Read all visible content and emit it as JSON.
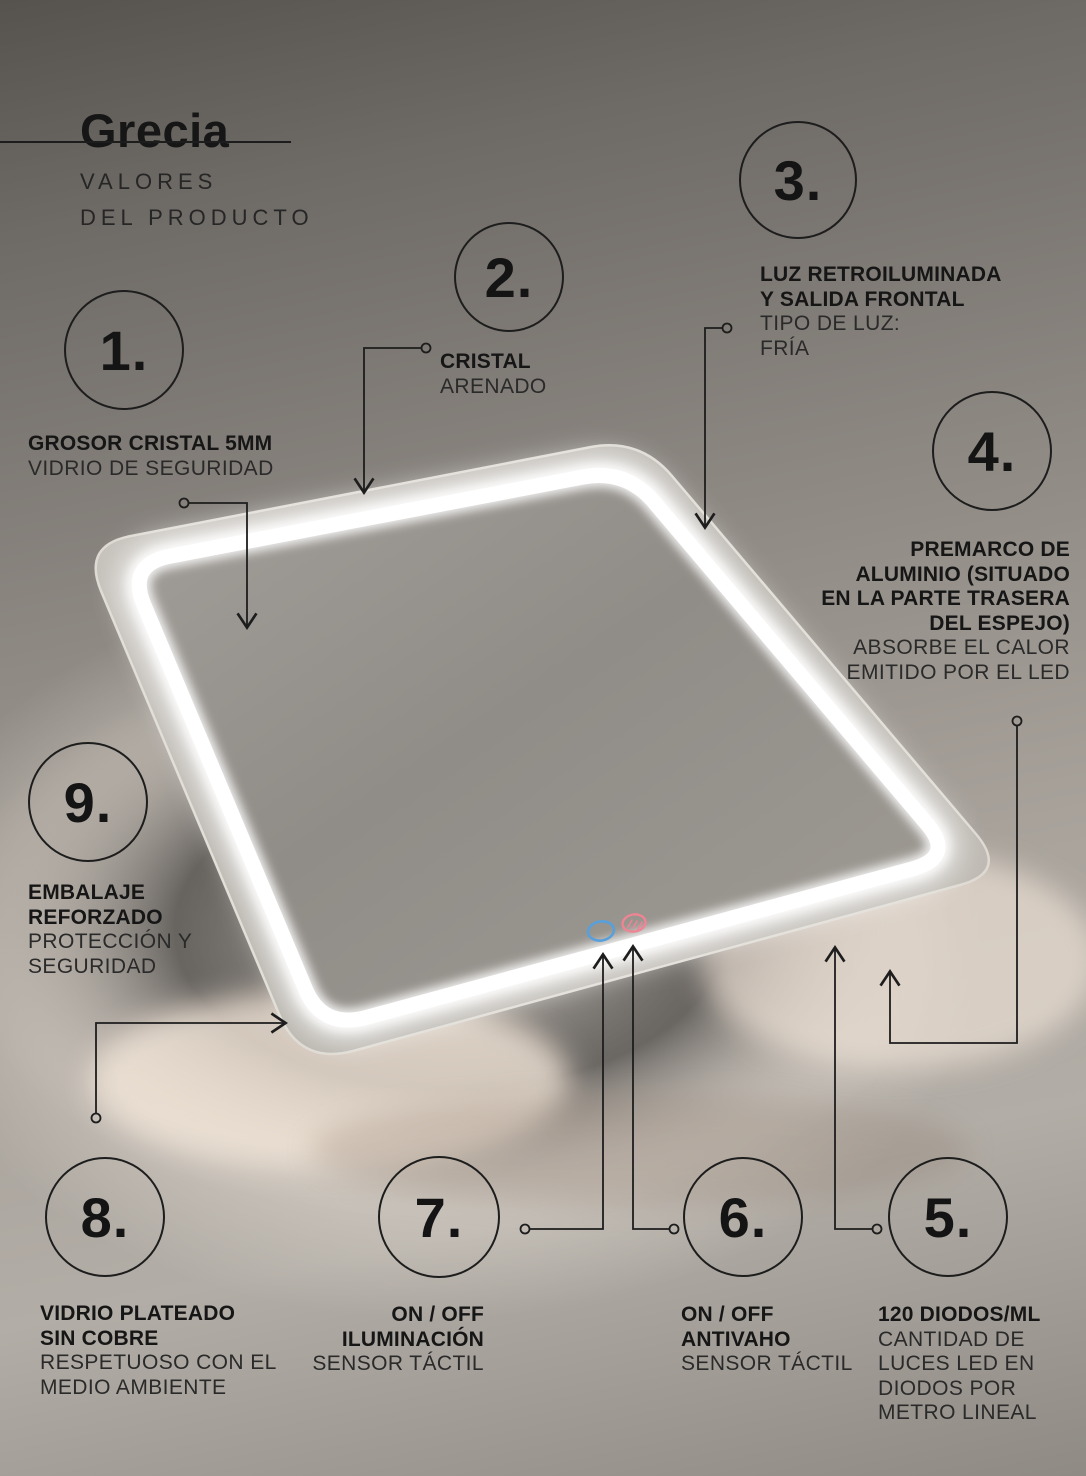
{
  "header": {
    "title": "Grecia",
    "subtitle": "VALORES\nDEL PRODUCTO"
  },
  "features": [
    {
      "number": "1.",
      "title": "GROSOR CRISTAL 5MM",
      "desc": "VIDRIO DE SEGURIDAD"
    },
    {
      "number": "2.",
      "title": "CRISTAL",
      "desc": "ARENADO"
    },
    {
      "number": "3.",
      "title": "LUZ RETROILUMINADA\nY SALIDA FRONTAL",
      "desc": "TIPO DE LUZ:\nFRÍA"
    },
    {
      "number": "4.",
      "title": "PREMARCO DE\nALUMINIO (SITUADO\nEN LA PARTE TRASERA\nDEL ESPEJO)",
      "desc": "ABSORBE EL CALOR\nEMITIDO POR EL LED"
    },
    {
      "number": "5.",
      "title": "120 DIODOS/ML",
      "desc": "CANTIDAD DE\nLUCES LED EN\nDIODOS POR\nMETRO LINEAL"
    },
    {
      "number": "6.",
      "title": "ON / OFF\nANTIVAHO",
      "desc": "SENSOR TÁCTIL"
    },
    {
      "number": "7.",
      "title": "ON / OFF\nILUMINACIÓN",
      "desc": "SENSOR TÁCTIL"
    },
    {
      "number": "8.",
      "title": "VIDRIO PLATEADO\nSIN COBRE",
      "desc": "RESPETUOSO CON EL\nMEDIO AMBIENTE"
    },
    {
      "number": "9.",
      "title": "EMBALAJE\nREFORZADO",
      "desc": "PROTECCIÓN Y\nSEGURIDAD"
    }
  ],
  "product_view": {
    "type": "backlit-led-mirror-perspective",
    "sensor_power_color": "#58a0dc",
    "sensor_antifog_color": "#ee8494",
    "led_color": "#ffffff",
    "callout_line_color": "#1d1d1d"
  },
  "colors": {
    "text": "#1d1d1d",
    "background_top": "#56524e",
    "background_glow": "#f4ece3"
  }
}
